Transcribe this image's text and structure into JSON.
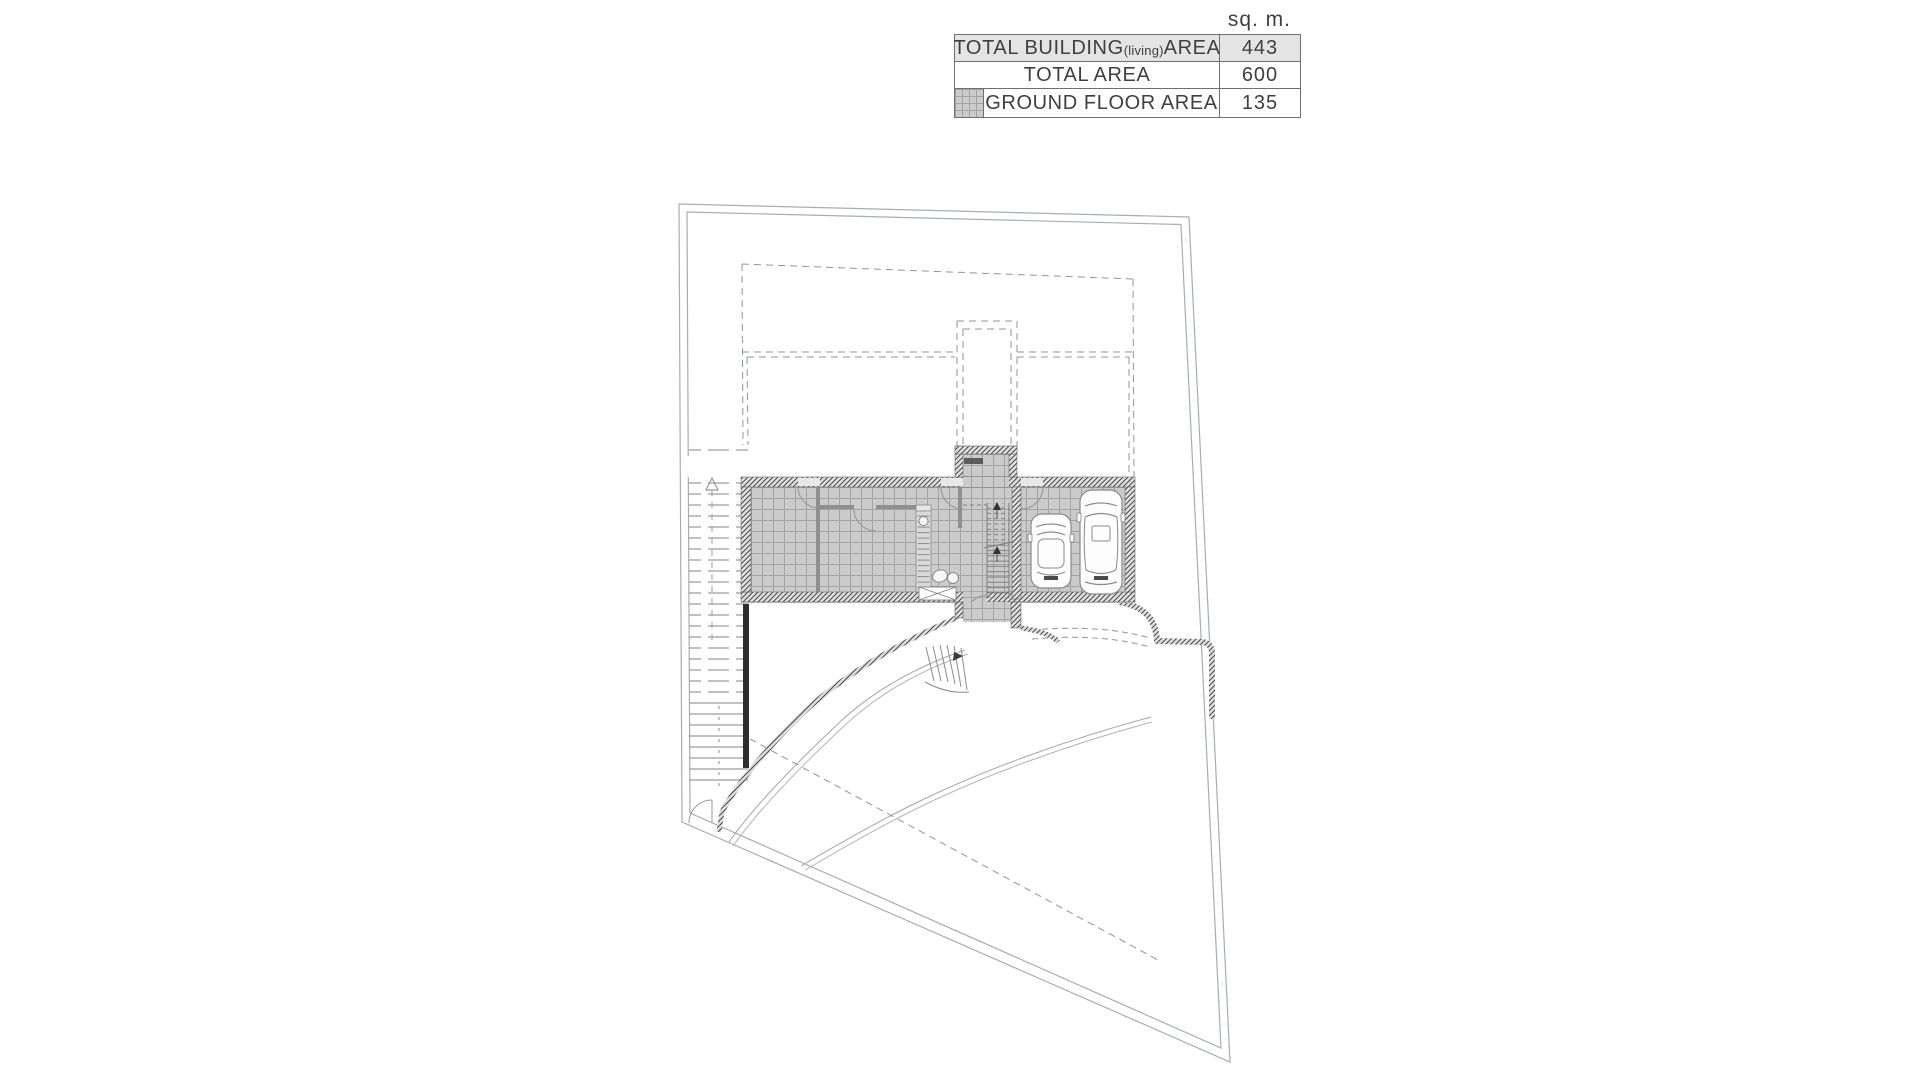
{
  "table": {
    "unit_label": "sq. m.",
    "rows": [
      {
        "label_main": "TOTAL BUILDING",
        "label_sub": "(living)",
        "label_tail": " AREA",
        "value": "443"
      },
      {
        "label_main": "TOTAL AREA",
        "label_sub": "",
        "label_tail": "",
        "value": "600"
      },
      {
        "label_main": "GROUND FLOOR AREA",
        "label_sub": "",
        "label_tail": "",
        "value": "135"
      }
    ],
    "swatch_icon": "ground-floor-hatch-swatch"
  },
  "plan": {
    "icons": [
      "site-boundary",
      "upper-floor-dashed-outline",
      "ground-floor-slab",
      "entry-vestibule",
      "interior-stair",
      "car-top-view",
      "car-top-view",
      "garden-steps",
      "driveway-curve",
      "left-terrace-steps",
      "gate-door-arc"
    ],
    "colors": {
      "boundary_line": "#a8adb0",
      "dashed_line": "#8f9699",
      "wall_hatch": "#4e4e4e",
      "tile_fill": "#cbcbcb",
      "tile_grid": "#a3a3a3",
      "dark_wall": "#2e2e2e",
      "text": "#3f3f3f",
      "row_highlight": "#e4e4e4"
    }
  }
}
